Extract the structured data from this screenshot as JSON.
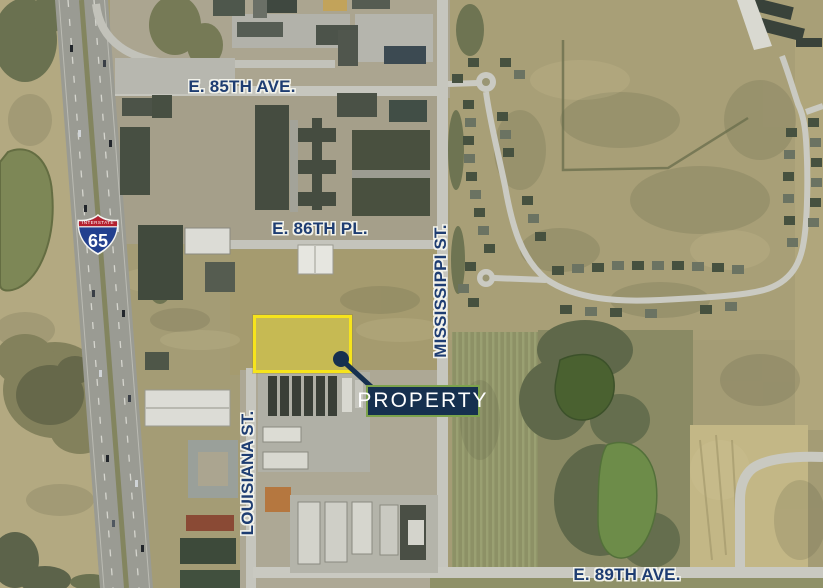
{
  "map": {
    "street_labels": {
      "e85th_ave": "E. 85TH AVE.",
      "e86th_pl": "E. 86TH PL.",
      "mississippi_st": "MISSISSIPPI ST.",
      "louisiana_st": "LOUISIANA ST.",
      "e89th_ave": "E. 89TH AVE."
    },
    "interstate_shield": {
      "banner": "INTERSTATE",
      "route_number": "65"
    },
    "property_callout": {
      "label": "PROPERTY"
    },
    "colors": {
      "street_label_blue": "#1e3d72",
      "label_halo": "#f2f2ea",
      "highlight_yellow": "#f6e41c",
      "callout_navy": "#16304f",
      "callout_border_green": "#7ca24c",
      "callout_text": "#ffffff",
      "shield_red": "#b5202e",
      "shield_blue": "#23408f"
    }
  }
}
